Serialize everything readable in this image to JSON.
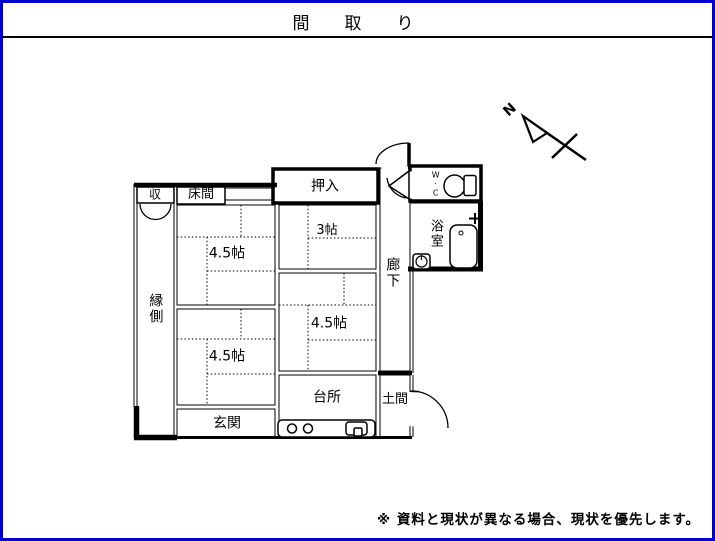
{
  "title": "間　取　り",
  "footer": {
    "note": "※ 資料と現状が異なる場合、現状を優先します。"
  },
  "compass": {
    "north_label": "N"
  },
  "rooms": {
    "storage": "収",
    "tokonoma": "床間",
    "oshiire": "押入",
    "room_3mat": "3帖",
    "room_45mat_top_left": "4.5帖",
    "room_45mat_bottom_left": "4.5帖",
    "room_45mat_middle_right": "4.5帖",
    "engawa": "縁側",
    "corridor": "廊下",
    "wc": "W·C",
    "bathroom": "浴室",
    "kitchen": "台所",
    "genkan": "玄関",
    "doma": "土間"
  },
  "colors": {
    "frame_border": "#0000cc",
    "line": "#000000"
  }
}
